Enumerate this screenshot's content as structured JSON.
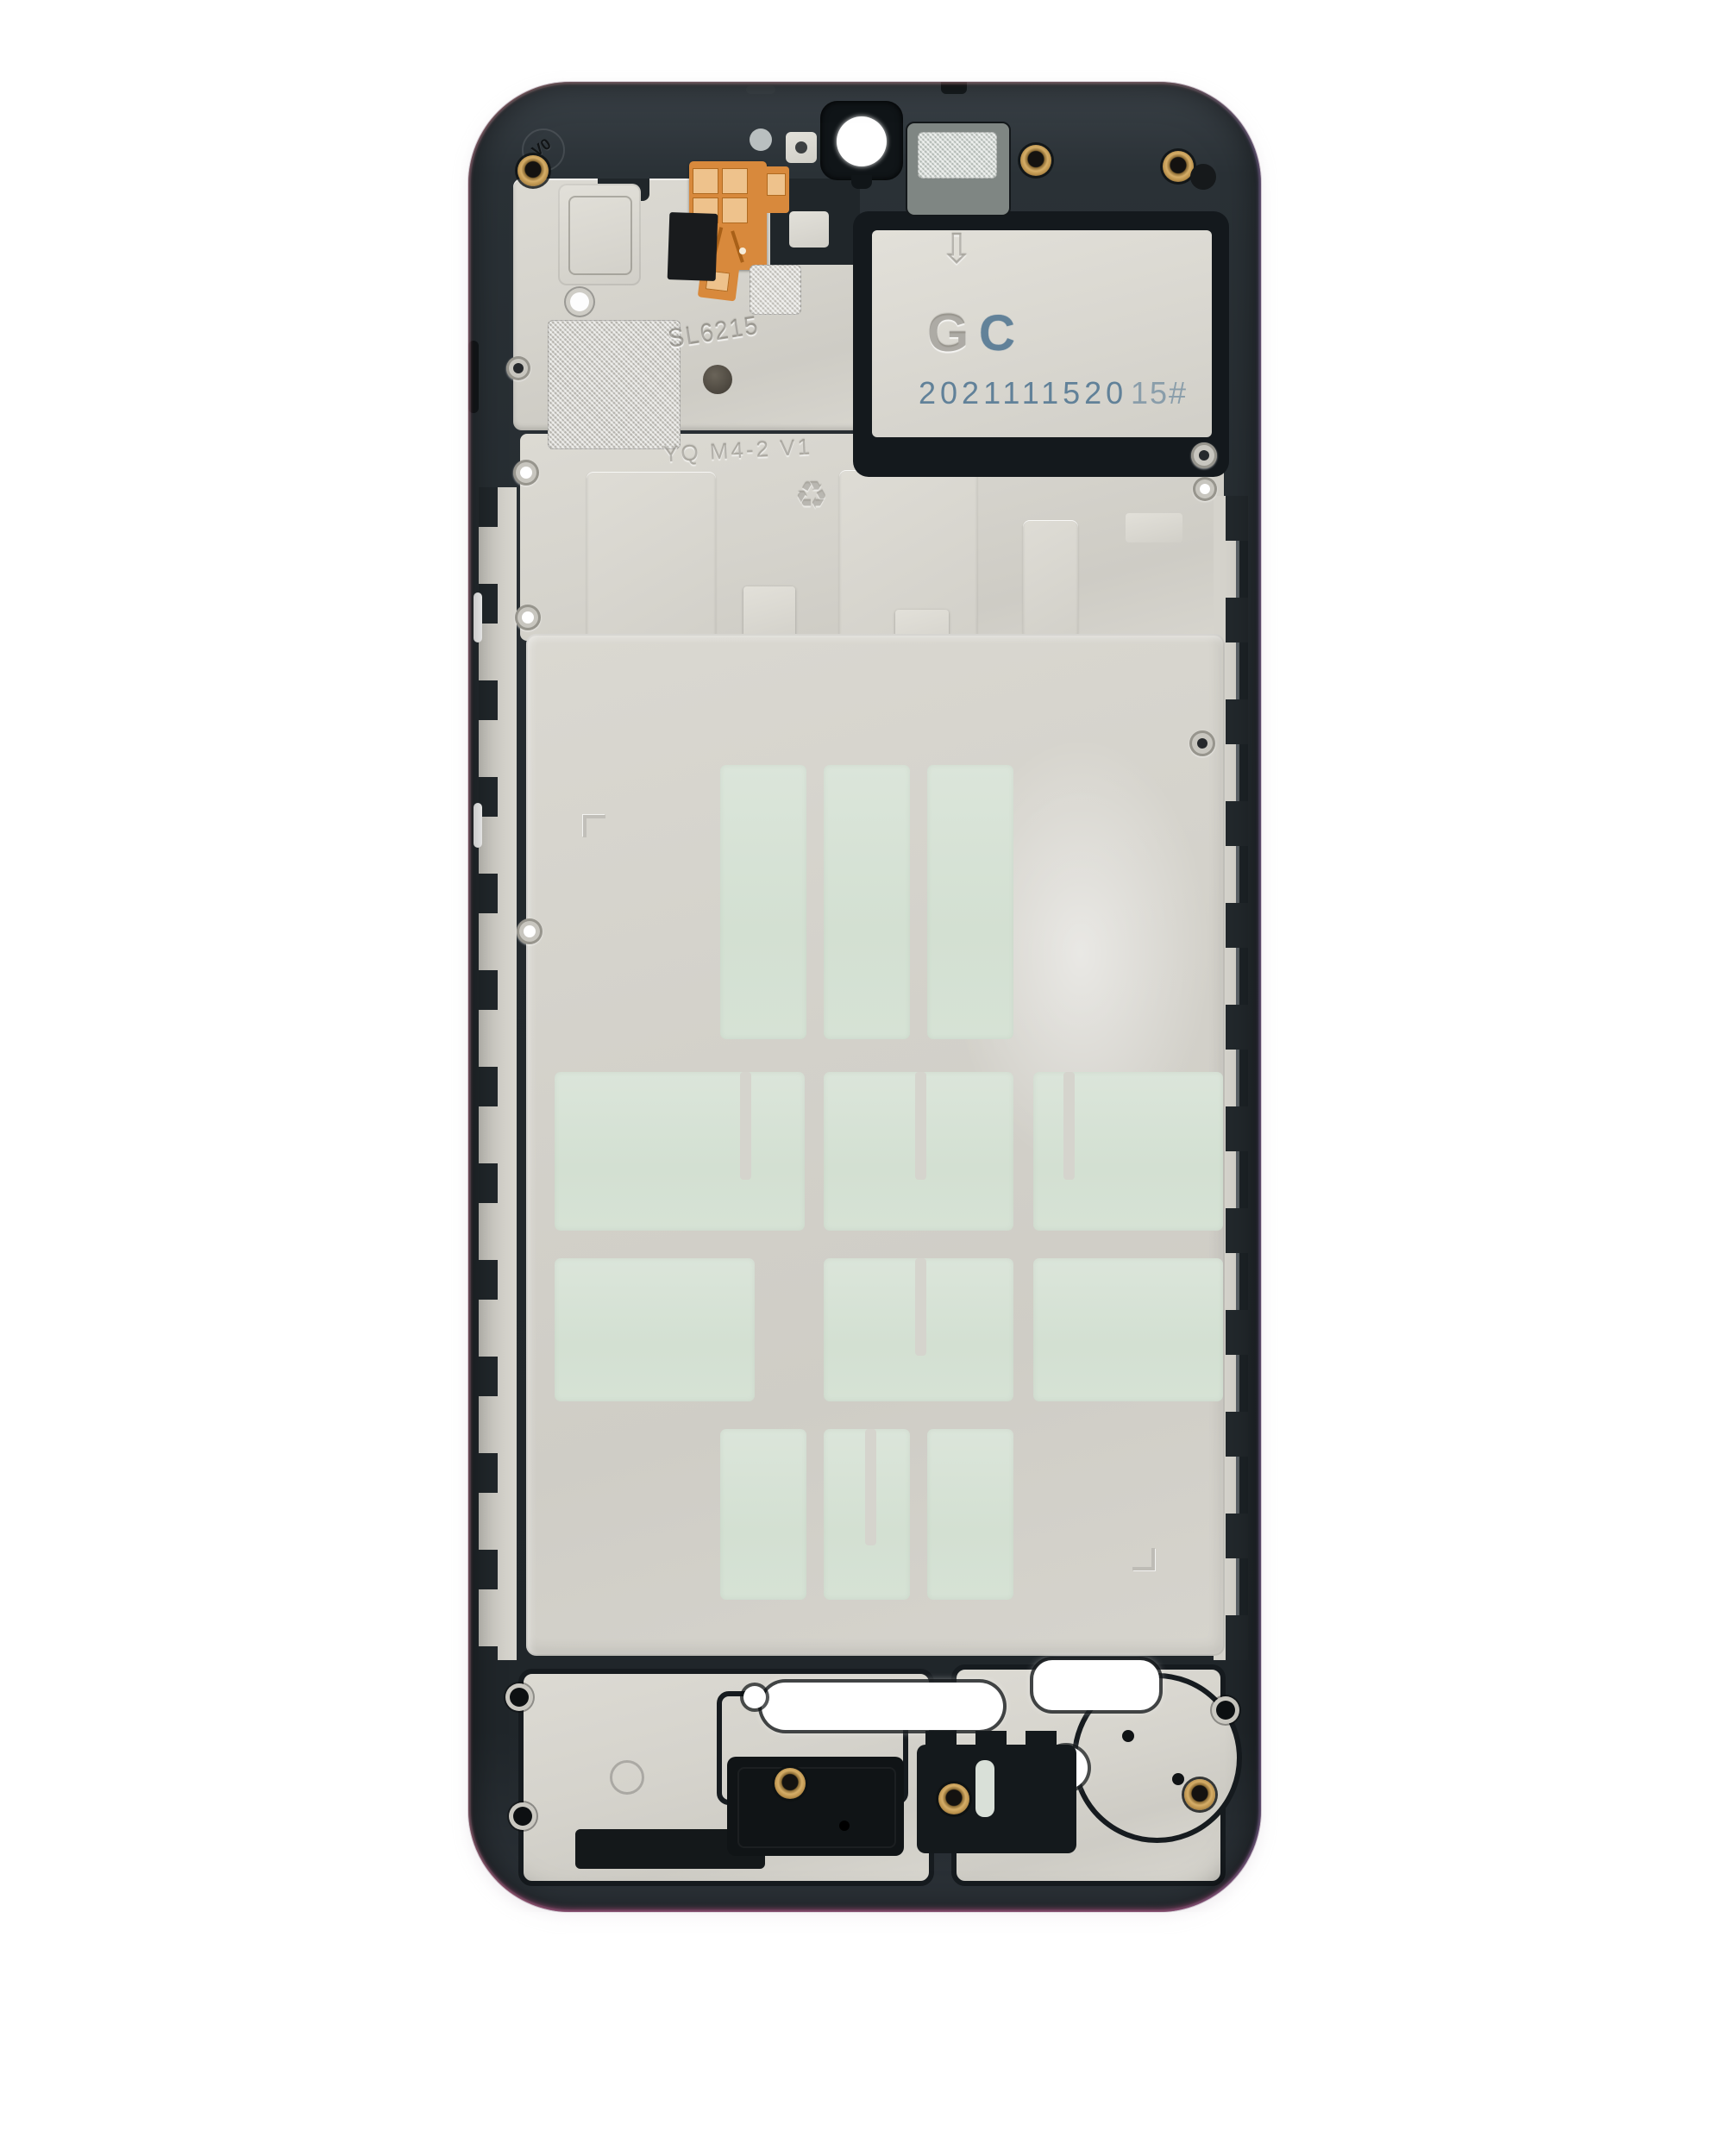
{
  "product_photo": {
    "subject": "smartphone-midframe-front-housing",
    "markings": {
      "flammability_rating": "V0",
      "shield_code": "SL6215",
      "mold_code": "YQ M4-2 V1",
      "plate_letter_embossed": "G",
      "plate_letter_printed": "C",
      "date_code": "2021111520",
      "station_code": "15#"
    },
    "icon_glyphs": {
      "recycle": "♻",
      "down_arrow": "⇩"
    },
    "colors": {
      "background": "#ffffff",
      "frame_dark": "#272d32",
      "metal_plate": "#d6d4cd",
      "adhesive_mint": "#d5e1d4",
      "flex_orange": "#d8893c",
      "brass_eyelet": "#c9a35d",
      "printed_ink_blue": "#4d7390"
    }
  }
}
